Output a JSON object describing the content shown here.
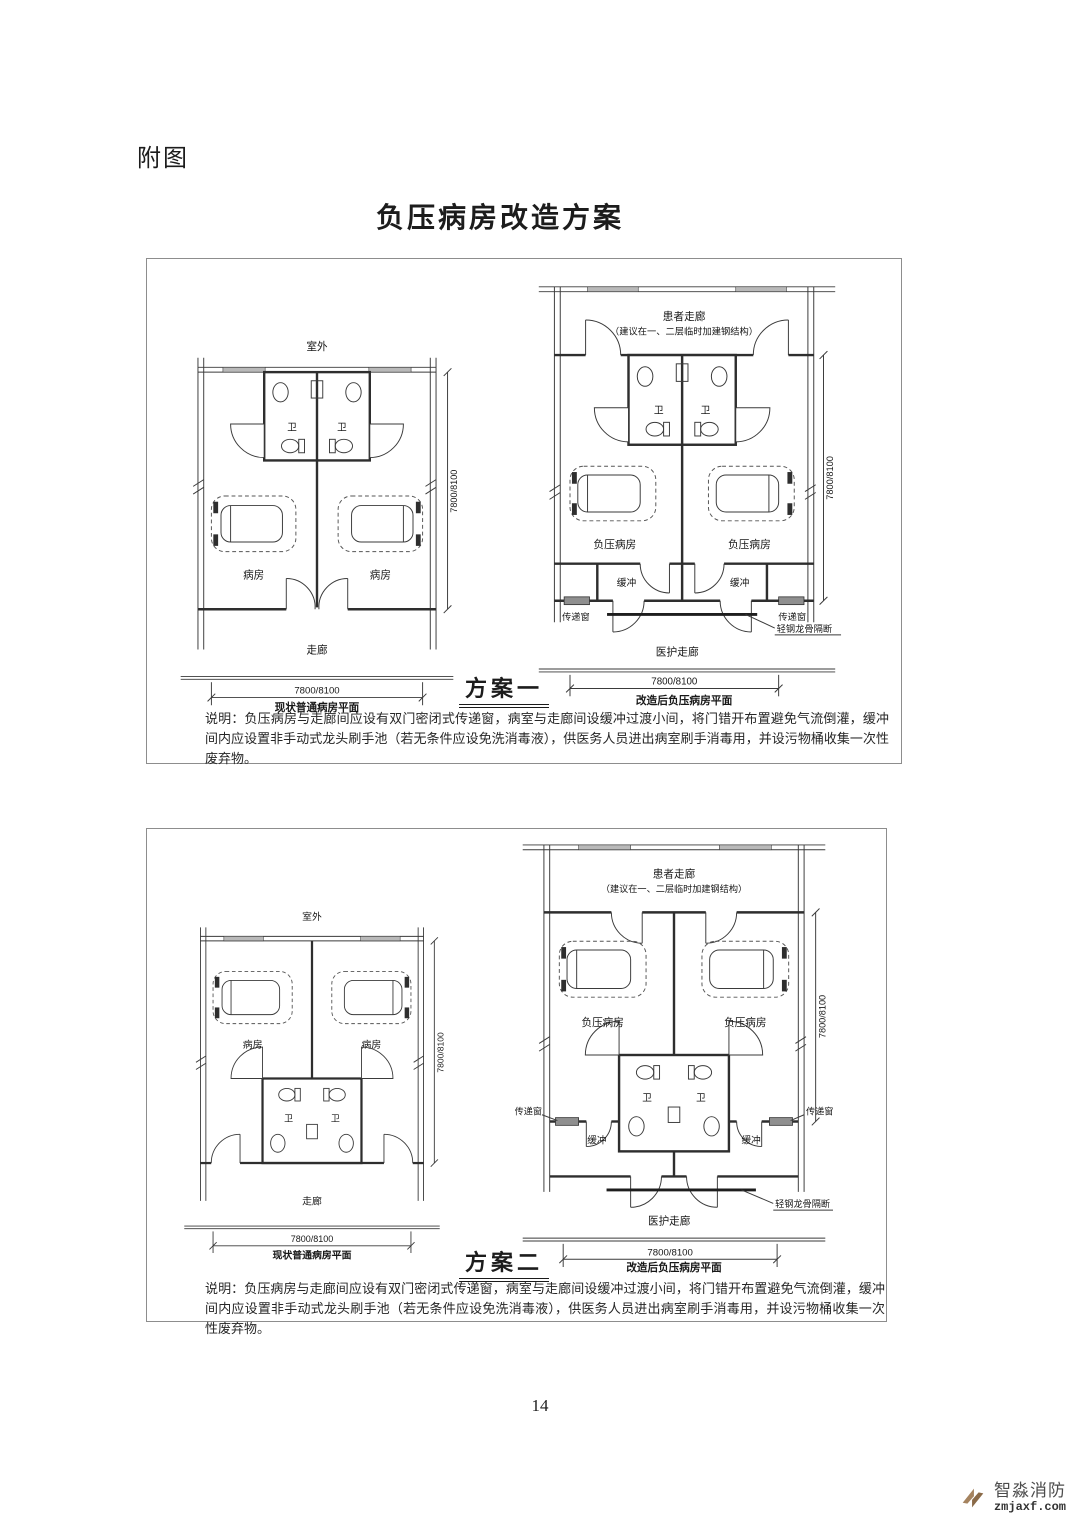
{
  "page": {
    "header_label": "附图",
    "title": "负压病房改造方案",
    "page_number": "14"
  },
  "watermark": {
    "brand": "智淼消防",
    "domain": "zmjaxf.com",
    "logo_color": "#a5835f"
  },
  "schemes": [
    {
      "name": "方案一",
      "note": "说明：负压病房与走廊间应设有双门密闭式传递窗，病室与走廊间设缓冲过渡小间，将门错开布置避免气流倒灌，缓冲间内应设置非手动式龙头刷手池（若无条件应设免洗消毒液），供医务人员进出病室刷手消毒用，并设污物桶收集一次性废弃物。",
      "current_plan": {
        "outside": "室外",
        "toilet": "卫",
        "ward": "病房",
        "corridor": "走廊",
        "dim_h": "7800/8100",
        "dim_v": "7800/8100",
        "caption": "现状普通病房平面"
      },
      "renovated_plan": {
        "patient_corridor": "患者走廊",
        "patient_corridor_note": "（建议在一、二层临时加建钢结构）",
        "toilet": "卫",
        "ward": "负压病房",
        "buffer": "缓冲",
        "transfer_window": "传递窗",
        "partition": "轻钢龙骨隔断",
        "staff_corridor": "医护走廊",
        "dim_h": "7800/8100",
        "dim_v": "7800/8100",
        "caption": "改造后负压病房平面"
      }
    },
    {
      "name": "方案二",
      "note": "说明：负压病房与走廊间应设有双门密闭式传递窗，病室与走廊间设缓冲过渡小间，将门错开布置避免气流倒灌，缓冲间内应设置非手动式龙头刷手池（若无条件应设免洗消毒液），供医务人员进出病室刷手消毒用，并设污物桶收集一次性废弃物。",
      "current_plan": {
        "outside": "室外",
        "toilet": "卫",
        "ward": "病房",
        "corridor": "走廊",
        "dim_h": "7800/8100",
        "dim_v": "7800/8100",
        "caption": "现状普通病房平面"
      },
      "renovated_plan": {
        "patient_corridor": "患者走廊",
        "patient_corridor_note": "（建议在一、二层临时加建钢结构）",
        "toilet": "卫",
        "ward": "负压病房",
        "buffer": "缓冲",
        "transfer_window": "传递窗",
        "partition": "轻钢龙骨隔断",
        "staff_corridor": "医护走廊",
        "dim_h": "7800/8100",
        "dim_v": "7800/8100",
        "caption": "改造后负压病房平面"
      }
    }
  ]
}
